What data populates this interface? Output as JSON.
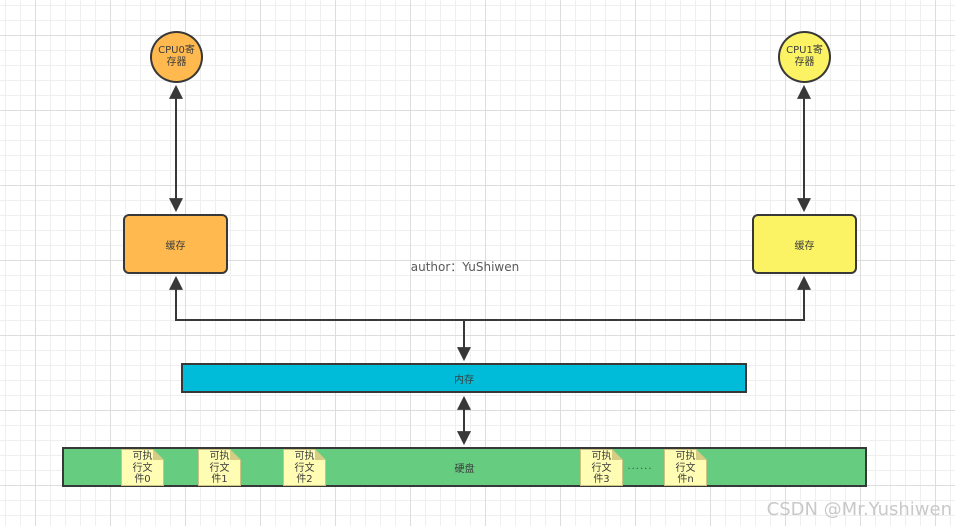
{
  "canvas": {
    "width": 955,
    "height": 526
  },
  "colors": {
    "cpu0_fill": "#FFB94E",
    "cpu1_fill": "#FBF264",
    "cache_left_fill": "#FFB94E",
    "cache_right_fill": "#FBF264",
    "memory_fill": "#00BCD9",
    "disk_fill": "#66CC80",
    "note_fill": "#FFFDB3",
    "note_fold": "#D6CD84",
    "connector_stroke": "#383838",
    "grid_minor": "#EFEFEF",
    "grid_major": "#DDDDDD",
    "watermark_text": "#C9C9C9"
  },
  "nodes": {
    "cpu0": {
      "label": "CPU0寄存器"
    },
    "cpu1": {
      "label": "CPU1寄存器"
    },
    "cache_left": {
      "label": "缓存"
    },
    "cache_right": {
      "label": "缓存"
    },
    "memory": {
      "label": "内存"
    },
    "disk": {
      "label": "硬盘"
    }
  },
  "disk_files": [
    {
      "label": "可执行文件0"
    },
    {
      "label": "可执行文件1"
    },
    {
      "label": "可执行文件2"
    },
    {
      "label": "可执行文件3"
    },
    {
      "label": "可执行文件n"
    }
  ],
  "annotations": {
    "author": "author：YuShiwen",
    "ellipsis": "......",
    "watermark": "CSDN @Mr.Yushiwen"
  }
}
